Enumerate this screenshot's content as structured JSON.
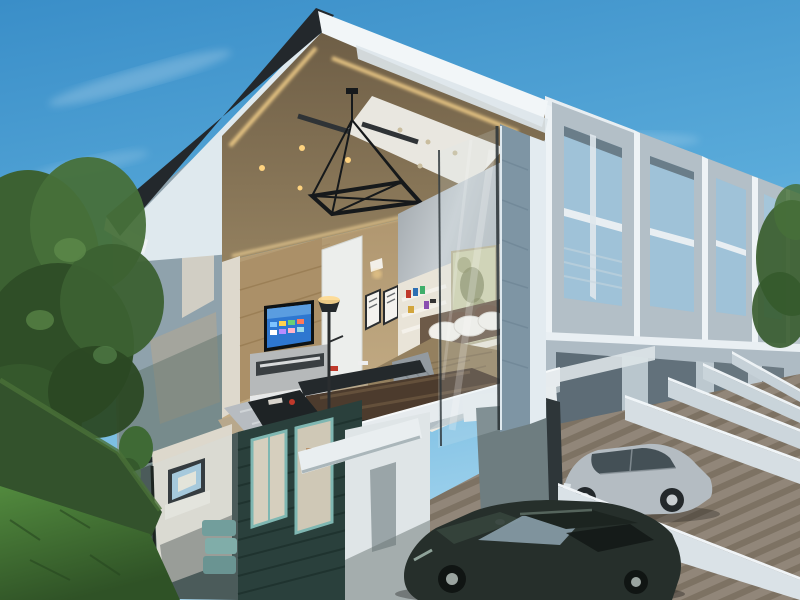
{
  "meta": {
    "description": "Photorealistic 3D architectural rendering of a modern two-storey townhouse row shown in cutaway cross-section, revealing an upstairs bedroom and lounge above a ground floor, with private driveways, two parked cars, garden and blue sky",
    "style": "daylight exterior render, no visible text"
  },
  "palette": {
    "sky_top": "#3a8ec8",
    "sky_mid": "#5aabda",
    "sky_horizon": "#a6d6ee",
    "roof_black": "#23282c",
    "fascia_white": "#f2f6f8",
    "soffit_wood": "#7b6a50",
    "wall_wood": "#c3ab84",
    "led_glow": "#ffd98f",
    "white_gable": "#dfe9ee",
    "tv_screen_blue": "#2e77d0",
    "duvet_taupe": "#94805f",
    "pillow_white": "#f2f0ea",
    "sofa_brown": "#4c3b2d",
    "rug_gray": "#b7bcc1",
    "art_olive": "#cfd0ad",
    "siding_teal": "#2a403c",
    "window_frame_teal": "#7fb7b2",
    "column_bluegray": "#7e95a4",
    "slab_white": "#e6ebee",
    "distant_concrete": "#b3bfc7",
    "distant_glass": "#9fc2d8",
    "divider_wall": "#d6dee3",
    "paving_light": "#9b9184",
    "paving_stripe": "#847a6c",
    "grass_light": "#528a3e",
    "grass_dark": "#2f5226",
    "hedge_green": "#33522c",
    "tree_green": "#3c6132",
    "car_silver": "#b4bcc2",
    "car_dark_green": "#262f2b"
  },
  "scene": {
    "objects": [
      "blue gradient sky with thin clouds",
      "large tree and hedge on the left with lawn",
      "cutaway townhouse: black-edged sloping roof with white fascia",
      "wood soffit ceiling with cove LED lighting, spotlights and black geometric chandelier",
      "upstairs bedroom: wall TV with blue smart-tv screen, media console, floor lamp, framed pictures, white door",
      "bed with taupe duvet, white pillows, gray throw, nightstand",
      "portrait artwork and white shelves with books",
      "brown leather sofa, dark sideboard, gray shag rug",
      "white concrete floor slab cut edge",
      "ground floor glass wall with small TV, plants and teal decor",
      "dark teal horizontal clapboard siding with teal-framed windows",
      "white carport wall and canopy",
      "row of identical townhouse facades with concrete window frames receding right",
      "white driveway divider walls radiating toward viewer",
      "striped wood-look driveway paving",
      "silver sedan parked behind divider wall",
      "dark green sedan in foreground driveway"
    ]
  }
}
